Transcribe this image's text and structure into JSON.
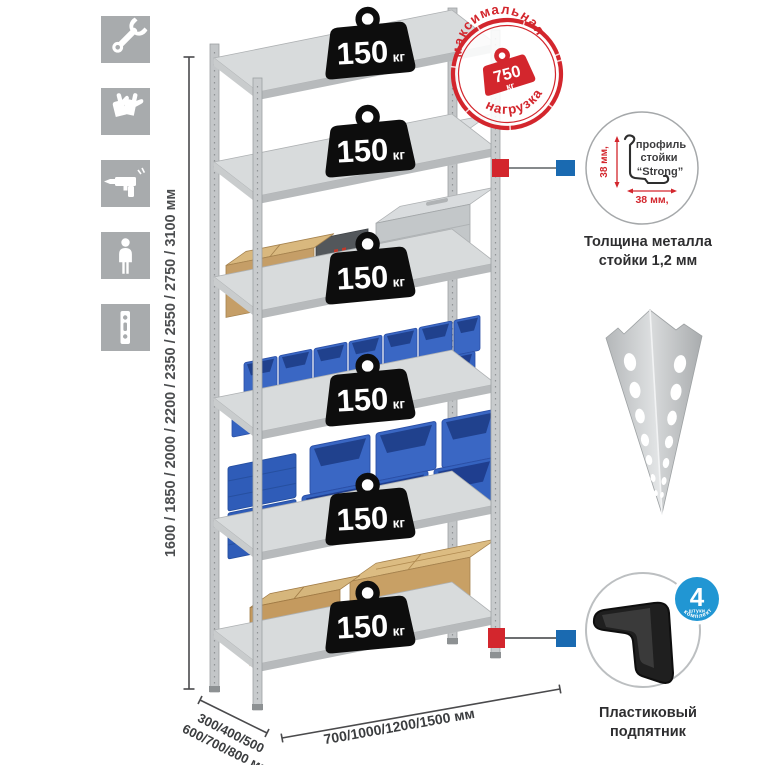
{
  "colors": {
    "accent_red": "#d3262d",
    "accent_blue": "#1a6ab1",
    "badge_blue": "#2196d3",
    "bin_blue": "#3a67c4",
    "cardboard": "#c59e67",
    "metal_gray": "#c8cbcd",
    "icon_bg": "#a8abad"
  },
  "sidebar": {
    "icons": [
      {
        "name": "wrench-icon"
      },
      {
        "name": "gloves-icon"
      },
      {
        "name": "drill-icon"
      },
      {
        "name": "person-icon"
      },
      {
        "name": "upright-profile-icon"
      }
    ]
  },
  "dimensions": {
    "height": "1600 / 1850 / 2000 / 2200 / 2350 / 2550 / 2750 / 3100 мм",
    "depth_line1": "300/400/500",
    "depth_line2": "600/700/800 мм",
    "width": "700/1000/1200/1500 мм"
  },
  "shelf_load": {
    "value": "150",
    "unit": "кг"
  },
  "max_load": {
    "arc_top": "максимальная",
    "arc_bottom": "нагрузка",
    "value": "750",
    "unit": "кг"
  },
  "profile_detail": {
    "line1": "профиль",
    "line2": "стойки",
    "line3": "“Strong”",
    "dim_vertical": "38 мм,",
    "dim_horizontal": "38 мм,",
    "caption_line1": "Толщина металла",
    "caption_line2": "стойки 1,2 мм"
  },
  "foot_detail": {
    "badge_number": "4",
    "badge_sub": "штуки",
    "badge_arc": "в комплекте",
    "caption_line1": "Пластиковый",
    "caption_line2": "подпятник"
  }
}
